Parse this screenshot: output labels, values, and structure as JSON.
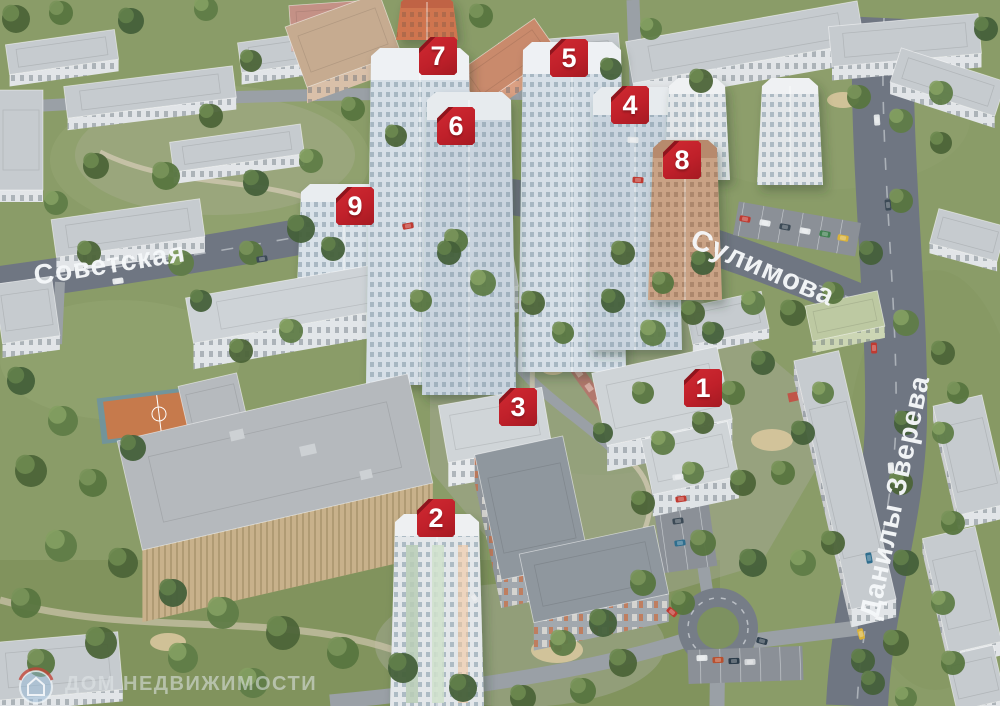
{
  "markers": [
    {
      "number": "1"
    },
    {
      "number": "2"
    },
    {
      "number": "3"
    },
    {
      "number": "4"
    },
    {
      "number": "5"
    },
    {
      "number": "6"
    },
    {
      "number": "7"
    },
    {
      "number": "8"
    },
    {
      "number": "9"
    }
  ],
  "streets": [
    {
      "name": "Советская"
    },
    {
      "name": "Сулимова"
    },
    {
      "name": "Данилы Зверева"
    }
  ],
  "watermark": {
    "text": "ДОМ НЕДВИЖИМОСТИ",
    "logo_icon": "house-circle-logo"
  },
  "colors": {
    "marker_red": "#c0202a",
    "marker_red_shadow": "#8e151d",
    "road_label_white": "#f5f7f9",
    "logo_blue": "#96b9d7",
    "logo_arc_red": "#c2453a",
    "grass_green": "#8a9c68",
    "road_gray": "#6f7682"
  }
}
